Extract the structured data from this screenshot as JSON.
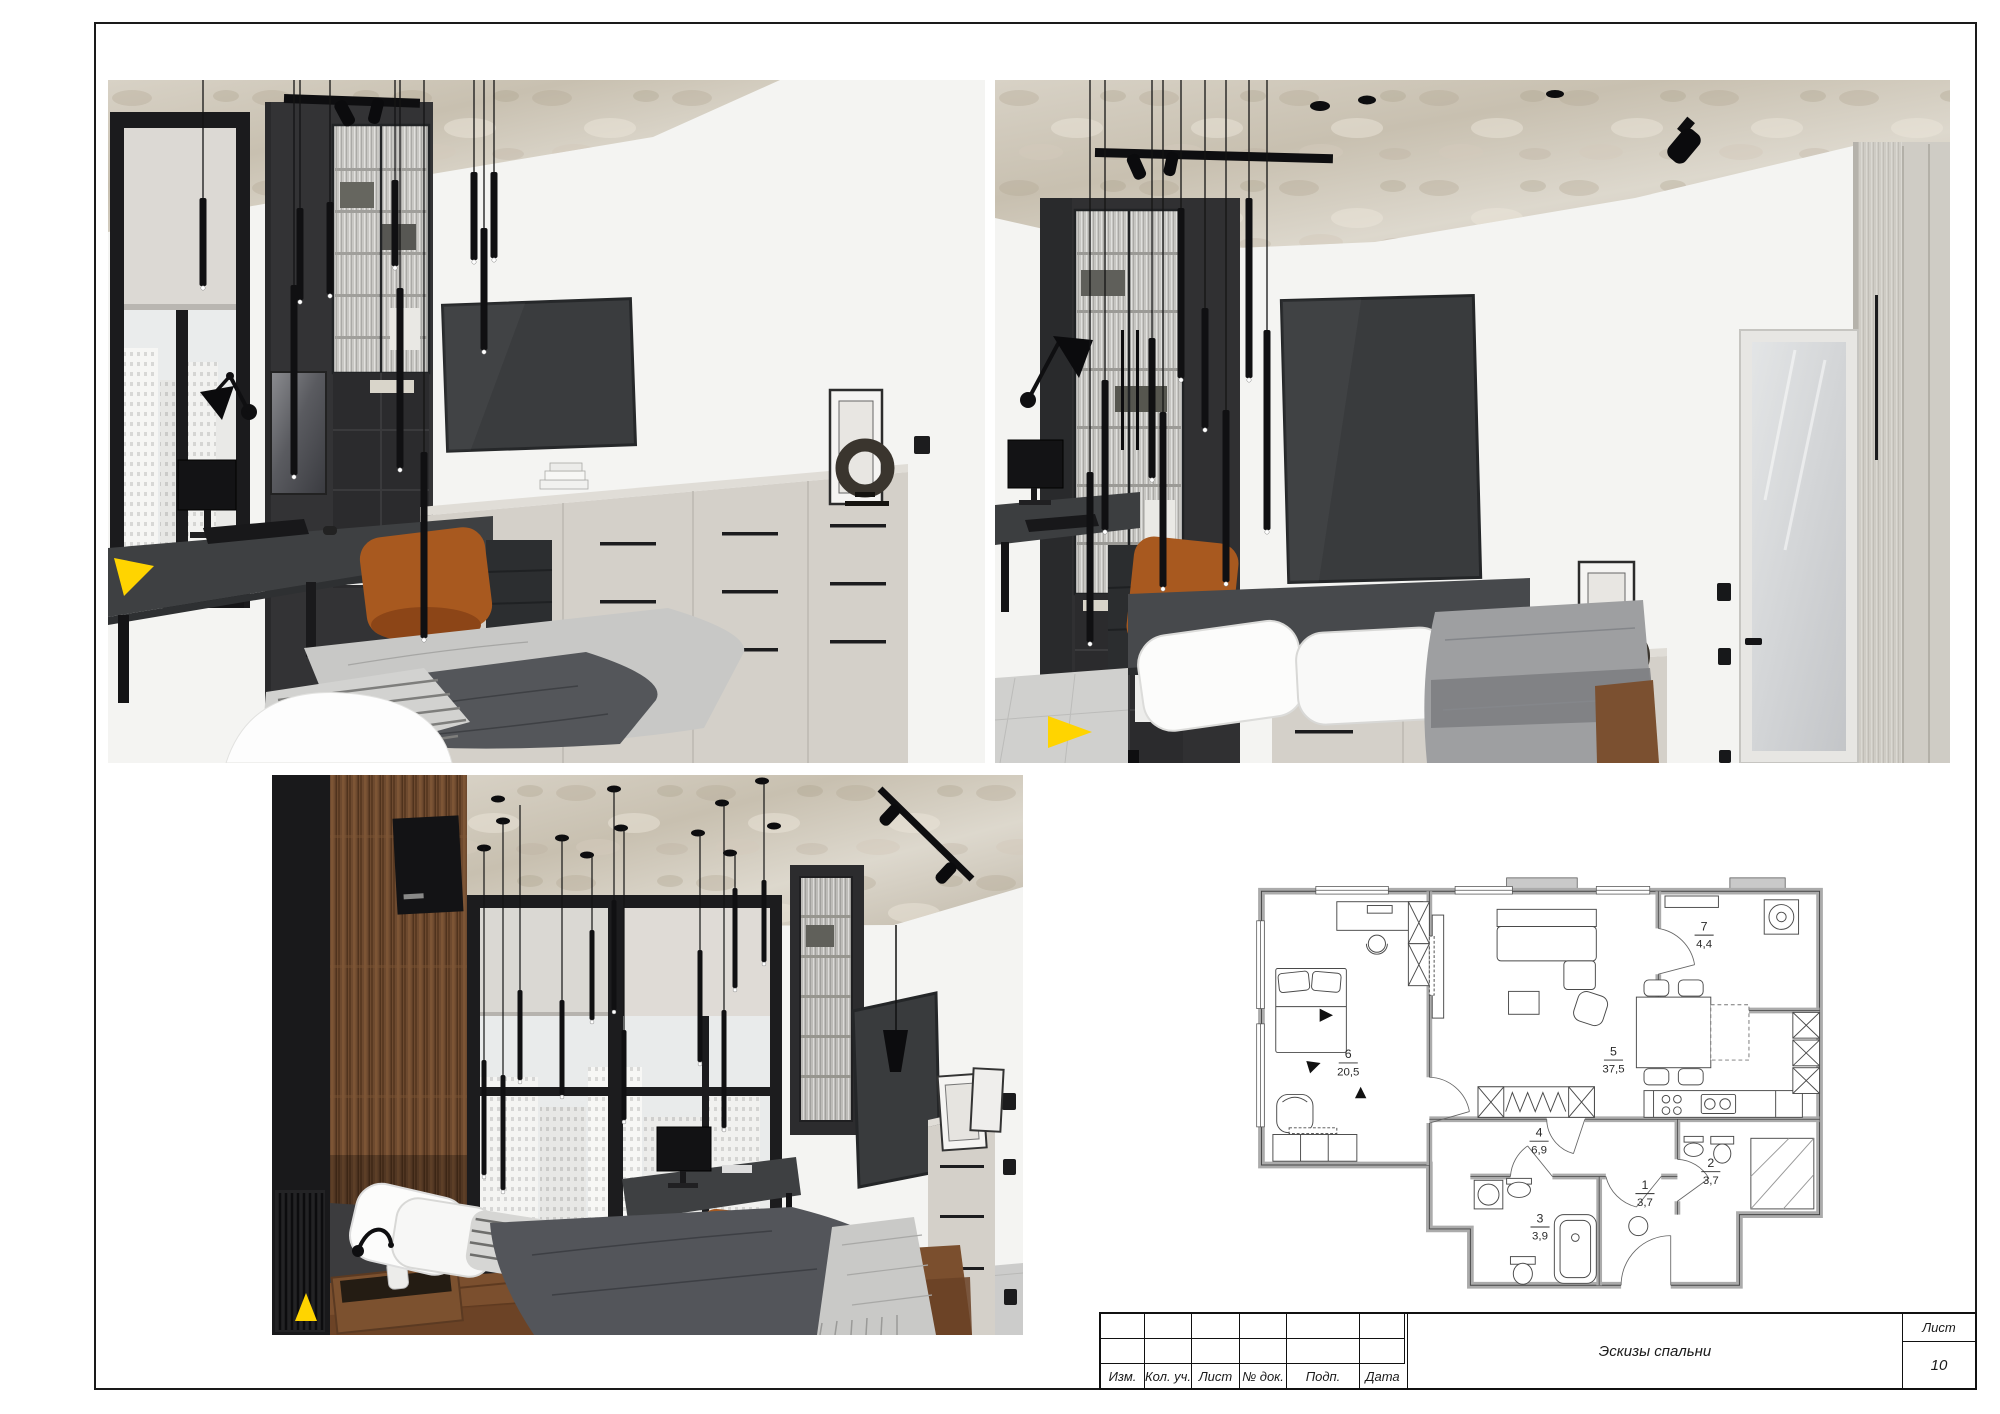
{
  "title_block": {
    "columns": [
      "Изм.",
      "Кол. уч.",
      "Лист",
      "№ док.",
      "Подп.",
      "Дата"
    ],
    "document_title": "Эскизы спальни",
    "sheet_label": "Лист",
    "sheet_number": "10"
  },
  "floor_plan": {
    "rooms": [
      {
        "number": "6",
        "area": "20,5"
      },
      {
        "number": "5",
        "area": "37,5"
      },
      {
        "number": "7",
        "area": "4,4"
      },
      {
        "number": "4",
        "area": "6,9"
      },
      {
        "number": "3",
        "area": "3,9"
      },
      {
        "number": "2",
        "area": "3,7"
      },
      {
        "number": "1",
        "area": "3,7"
      }
    ]
  },
  "colors": {
    "accent_yellow": "#ffd400",
    "chair_orange": "#a8591f",
    "furniture_charcoal": "#323234",
    "dresser_beige": "#d2cec7",
    "ceiling_concrete": "#cdc5b6",
    "wood_brown": "#6e4a2f"
  }
}
